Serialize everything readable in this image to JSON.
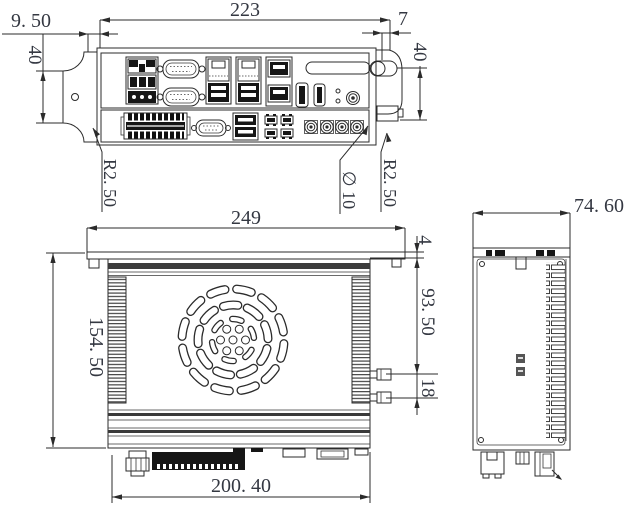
{
  "page": {
    "background": "#ffffff",
    "line_color": "#2b2b2b",
    "text_color": "#343842"
  },
  "views": {
    "front": {
      "dims": {
        "offset_left": "9. 50",
        "width": "223",
        "offset_right": "7",
        "height_left": "40",
        "height_right": "40",
        "notch_radius_left": "R2. 50",
        "hole_diameter": "∅ 10",
        "notch_radius_right": "R2. 50"
      },
      "ports": [
        "power-terminal-block",
        "serial-port",
        "serial-port",
        "lan-usb-combo",
        "lan-usb-combo",
        "usb-stack",
        "vent-slot",
        "hdmi-port",
        "displayport",
        "led-indicators",
        "audio-jack",
        "io-terminal-block",
        "serial-port",
        "usb-stack",
        "dio-connectors",
        "antenna-connectors"
      ]
    },
    "top": {
      "dims": {
        "bracket_width": "249",
        "depth": "154. 50",
        "body_width": "200. 40",
        "bracket_lip": "4",
        "antenna_offset": "93. 50",
        "antenna_spacing": "18"
      }
    },
    "side": {
      "dims": {
        "width": "74. 60"
      }
    }
  }
}
